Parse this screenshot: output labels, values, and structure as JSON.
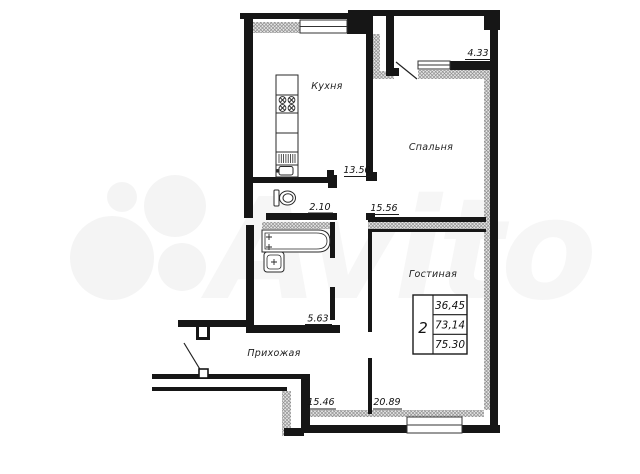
{
  "watermark": {
    "brand_text": "Avito"
  },
  "rooms": [
    {
      "key": "kitchen",
      "name": "Кухня",
      "area": "13.50"
    },
    {
      "key": "bedroom",
      "name": "Спальня",
      "area": "15.56"
    },
    {
      "key": "living_room",
      "name": "Гостиная",
      "area": "20.89"
    },
    {
      "key": "hallway",
      "name": "Прихожая",
      "area": "15.46"
    },
    {
      "key": "bathroom",
      "name": "",
      "area": "5.63"
    },
    {
      "key": "wc",
      "name": "",
      "area": "2.10"
    },
    {
      "key": "balcony",
      "name": "",
      "area": "4.33"
    }
  ],
  "stamp": {
    "rooms_count": "2",
    "living_area": "36,45",
    "total_area": "73,14",
    "area_with_balcony": "75.30"
  },
  "colors": {
    "wall": "#161616",
    "hatch_line": "#8f8f8f",
    "text": "#1a1a1a"
  }
}
